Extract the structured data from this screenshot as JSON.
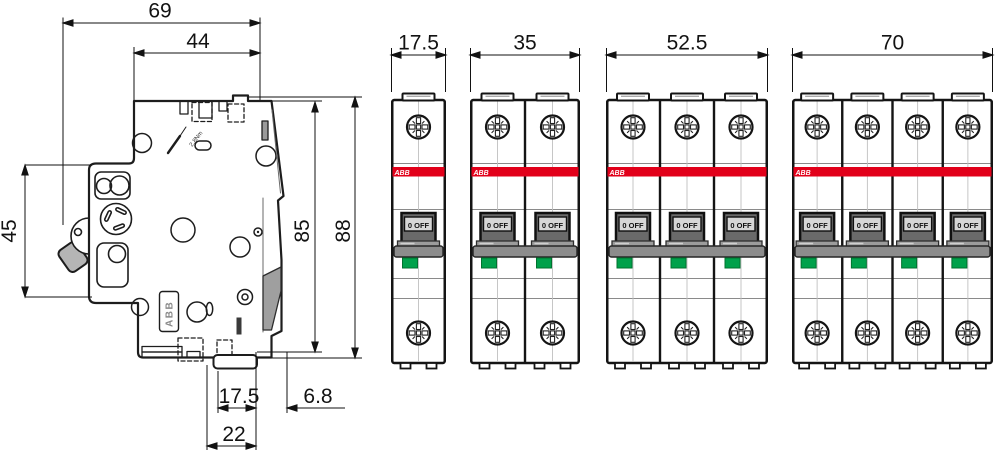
{
  "drawing_type": "technical-dimension-drawing",
  "side_view": {
    "labels": {
      "overall_width": "69",
      "upper_width": "44",
      "front_height": "45",
      "body_height": "85",
      "overall_height": "88",
      "clip_inner_width": "17.5",
      "clip_offset": "6.8",
      "clip_outer_width": "22"
    },
    "torque_label": "2.8Nm",
    "brand_label": "ABB"
  },
  "front_views": {
    "off_label": "0 OFF",
    "brand_label": "ABB",
    "units": [
      {
        "name": "1-pole breaker",
        "poles": 1,
        "width_label": "17.5"
      },
      {
        "name": "2-pole breaker",
        "poles": 2,
        "width_label": "35"
      },
      {
        "name": "3-pole breaker",
        "poles": 3,
        "width_label": "52.5"
      },
      {
        "name": "4-pole breaker",
        "poles": 4,
        "width_label": "70"
      }
    ]
  },
  "colors": {
    "abb_red": "#e2001a",
    "indicator_green": "#00a14b",
    "handle_gray": "#8c8c8c",
    "step_gray": "#9c9c9c",
    "frame_gray": "#6a6a6a",
    "window_gray": "#d6d6d6",
    "outline_black": "#141414"
  }
}
